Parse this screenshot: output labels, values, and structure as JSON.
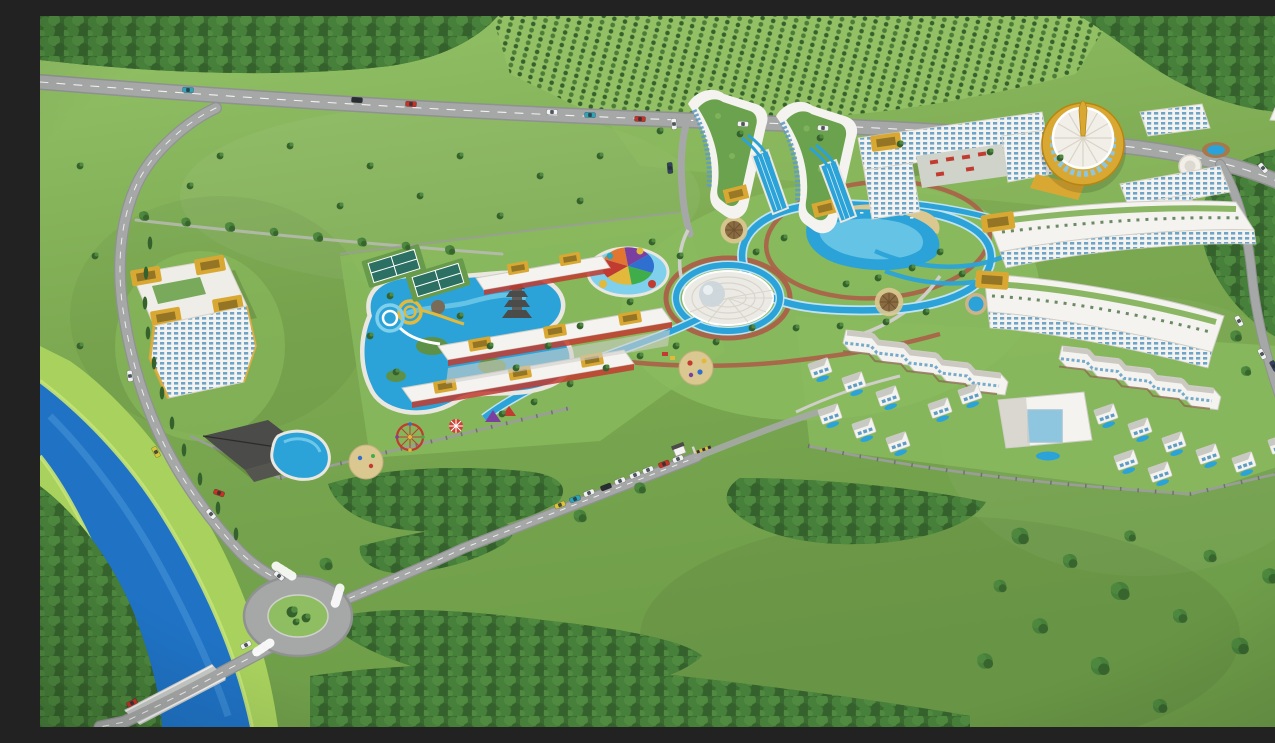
{
  "scene": {
    "name": "resort-masterplan-aerial-rendering",
    "type": "3d-architectural-aerial-view",
    "elements": [
      "orchard-field",
      "highway",
      "access-road",
      "tree-lined-lane",
      "roundabout",
      "river-bridge",
      "river",
      "entrance-gate",
      "entrance-driveway",
      "perimeter-wall",
      "left-apartment-building",
      "clubhouse",
      "clubhouse-pool",
      "waterpark-pool",
      "spiral-slides",
      "tennis-courts",
      "kids-splash-pool",
      "rainbow-canopy",
      "pagoda-tower",
      "retail-rows",
      "ferris-wheel",
      "carousel",
      "tents",
      "sand-playground",
      "amphitheater-dome",
      "lazy-river",
      "lagoon-beach-pool",
      "tiki-huts",
      "central-playground",
      "wave-apartment-towers",
      "slide-pools",
      "main-hotel",
      "courtyard-flowerbeds",
      "round-gold-tower",
      "garden-pavilions",
      "terraced-residence-a",
      "terraced-residence-b",
      "villa-zigzag-rows",
      "villas",
      "atrium-villa-building",
      "forest",
      "scattered-trees",
      "cars"
    ],
    "car_count": 31,
    "car_colors_seen": [
      "white",
      "red",
      "teal",
      "black",
      "yellow",
      "navy"
    ]
  },
  "colors": {
    "grass_light": "#8fbe62",
    "grass_mid": "#7ca951",
    "grass_dark": "#6b9a47",
    "lawn": "#8aba5e",
    "forest_base": "#3a6a30",
    "foliage_a": "#47803a",
    "foliage_b": "#35622c",
    "foliage_c": "#4f8a40",
    "orchard_field": "#94c065",
    "orchard_tree": "#4b7d39",
    "road": "#a6a8a7",
    "road_dark": "#8f9291",
    "road_line": "#ffffff",
    "path_red": "#ab6048",
    "path_gray": "#cfcfc9",
    "river": "#1f72c4",
    "river_light": "#4796d8",
    "bank": "#a8d15e",
    "bank_bright": "#c6e473",
    "pool": "#2ba3d8",
    "pool_light": "#7fd0ec",
    "pool_deep": "#1565a8",
    "sand": "#dbc790",
    "thatch": "#8a6b42",
    "bldg": "#f4f3ef",
    "bldg_shade": "#d2d0c8",
    "window": "#5f9cc4",
    "glass": "#8ec6e0",
    "gold": "#d9a833",
    "gold_dark": "#b8860f",
    "roof_dark": "#4b4b49",
    "roof_green": "#6ba24d",
    "red": "#c23b30",
    "purple": "#7b3fa0",
    "blue": "#2e6fd0",
    "green": "#3fae4a",
    "yellow": "#e2b93b",
    "orange": "#e2752f",
    "wall": "#9b9d9a",
    "car_white": "#f2f2f2",
    "car_red": "#c33327",
    "car_teal": "#2fa3b8",
    "car_black": "#2b2d30",
    "car_yellow": "#d9c43a",
    "car_navy": "#33415c"
  }
}
